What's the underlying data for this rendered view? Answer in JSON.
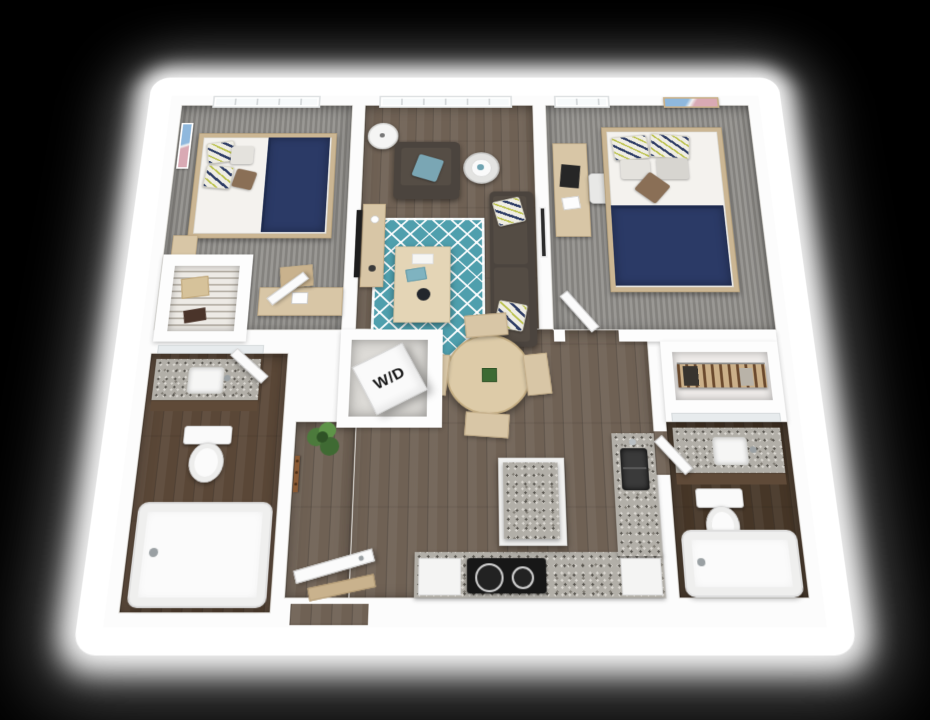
{
  "scene": {
    "type": "3d-floor-plan-render",
    "background_color": "#000000",
    "backdrop_color": "#ffffff"
  },
  "floor_plan": {
    "laundry_label": "W/D",
    "unit_summary": {
      "bedrooms": 2,
      "bathrooms": 2
    },
    "rooms": [
      {
        "id": "bedroom-1",
        "name": "Bedroom 1",
        "floor": "carpet",
        "furniture": [
          "bed-navy-blanket",
          "pillows",
          "nightstand",
          "desk",
          "desk-chair",
          "wall-art",
          "window",
          "door"
        ]
      },
      {
        "id": "closet-1",
        "name": "Closet",
        "furniture": [
          "wire-shelving",
          "storage-box"
        ]
      },
      {
        "id": "living-room",
        "name": "Living Room",
        "floor": "hardwood",
        "furniture": [
          "sofa",
          "patterned-accent-pillows",
          "armchair",
          "teal-pillow",
          "teal-trellis-rug",
          "coffee-table",
          "tv-console",
          "wall-tv",
          "floor-lamp",
          "side-table",
          "table-lamp",
          "windows",
          "wall-art"
        ]
      },
      {
        "id": "dining-area",
        "name": "Dining Area",
        "floor": "hardwood",
        "furniture": [
          "round-dining-table",
          "dining-chairs-x4",
          "centerpiece-plant"
        ]
      },
      {
        "id": "bedroom-2",
        "name": "Bedroom 2",
        "floor": "carpet",
        "furniture": [
          "bed-navy-blanket",
          "pillows",
          "desk",
          "laptop",
          "desk-chair",
          "wall-art",
          "window",
          "door"
        ]
      },
      {
        "id": "laundry-closet",
        "name": "Laundry Closet",
        "furniture": [
          "stacked-washer-dryer"
        ]
      },
      {
        "id": "bathroom-1",
        "name": "Bathroom 1",
        "floor": "hardwood",
        "furniture": [
          "granite-vanity",
          "sink",
          "mirror",
          "toilet",
          "bathtub",
          "door"
        ]
      },
      {
        "id": "entry",
        "name": "Entry",
        "floor": "hardwood",
        "furniture": [
          "coat-hooks",
          "potted-plant",
          "entry-door",
          "door-mat"
        ]
      },
      {
        "id": "kitchen",
        "name": "Kitchen",
        "floor": "hardwood",
        "furniture": [
          "l-shaped-granite-counter",
          "cooktop",
          "kitchen-sink",
          "island-granite-top",
          "refrigerator-cabinet"
        ]
      },
      {
        "id": "walk-in-closet",
        "name": "Walk-in Closet",
        "furniture": [
          "clothes-rod",
          "hanging-clothes"
        ]
      },
      {
        "id": "bathroom-2",
        "name": "Bathroom 2",
        "floor": "hardwood",
        "furniture": [
          "granite-vanity",
          "sink",
          "mirror",
          "toilet",
          "bathtub",
          "door"
        ]
      }
    ],
    "palette": {
      "wall": "#fcfcfc",
      "hardwood": "#6f6154",
      "carpet": "#8e8c88",
      "bathroom1_floor": "#5a4737",
      "bathroom2_floor": "#463627",
      "granite": "#b2afa8",
      "rug_teal": "#4f9fad",
      "sofa_gray": "#4b443e",
      "blanket_navy": "#2b3a66",
      "light_wood": "#d8c6a6",
      "plant_green": "#4c7a3c",
      "teal_pillow": "#7aa6b4"
    }
  }
}
